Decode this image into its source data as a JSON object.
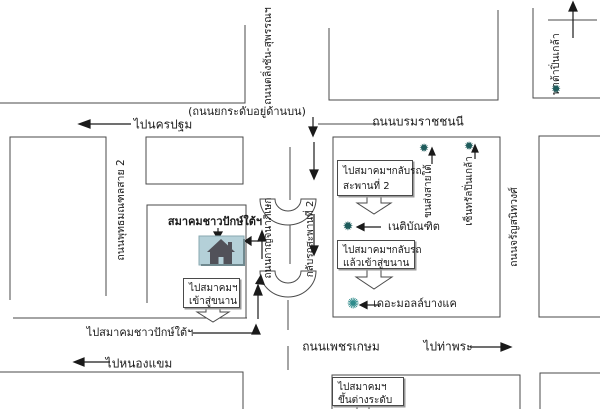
{
  "map": {
    "notes": {
      "elevated_road": "(ถนนยกระดับอยู่ด้านบน)"
    },
    "roads": {
      "borommaratchachonnani": "ถนนบรมราชชนนี",
      "taling_chan_suphan": "ถนนตลิ่งชัน-สุพรรณฯ",
      "phutthamonthon_sai_2": "ถนนพุทธมณฑลสาย 2",
      "kanchanaphisek": "ถนนกาญจนาภิเษก",
      "charansanitwong": "ถนนจรัญสนิทวงศ์",
      "phetkasem": "ถนนเพชรเกษม"
    },
    "directions": {
      "to_nakhon_pathom": "ไปนครปฐม",
      "to_nong_khaem": "ไปหนองแขม",
      "to_tha_phra": "ไปท่าพระ",
      "to_association": "ไปสมาคมชาวปักษ์ใต้ฯ"
    },
    "destination": {
      "label": "สมาคมชาวปักษ์ใต้ฯ"
    },
    "landmarks": {
      "uturn_bridge_2": "กลับรถสะพานที่ 2",
      "southern_bus_terminal": "ขนส่งสายใต้",
      "central_pinklao": "เซ็นทรัลปิ่นเกล้า",
      "pata_pinklao": "พาต้าปิ่นเกล้า",
      "netibandit": "เนติบัณฑิต",
      "the_mall_bangkae": "เดอะมอลล์บางแค"
    },
    "instruction_boxes": [
      {
        "line1": "ไปสมาคมฯกลับรถ",
        "line2": "สะพานที่ 2"
      },
      {
        "line1": "ไปสมาคมฯกลับรถ",
        "line2": "แล้วเข้าสู่ขนาน"
      },
      {
        "line1": "ไปสมาคมฯ",
        "line2": "เข้าสู่ขนาน"
      },
      {
        "line1": "ไปสมาคมฯ",
        "line2": "ขึ้นต่างระดับ"
      }
    ],
    "icons": {
      "star": "✹",
      "star_burst": "✺",
      "house": "house-icon"
    },
    "colors": {
      "line": "#4a4a4a",
      "arrow": "#1a1a1a",
      "house_box_bg": "#b4d0d8",
      "house": "#515159",
      "star": "#1f5c5c",
      "star_burst": "#2e8b8b"
    }
  }
}
